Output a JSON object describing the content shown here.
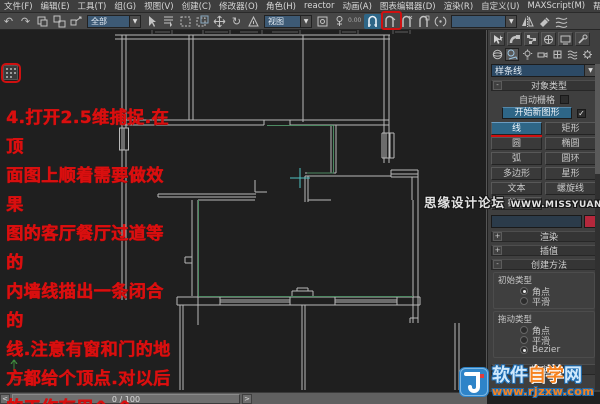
{
  "menu": {
    "items": [
      "文件(F)",
      "编辑(E)",
      "工具(T)",
      "组(G)",
      "视图(V)",
      "创建(C)",
      "修改器(O)",
      "角色(H)",
      "reactor",
      "动画(A)",
      "图表编辑器(D)",
      "渲染(R)",
      "自定义(U)",
      "MAXScript(M)",
      "帮助(H)"
    ]
  },
  "toolbar": {
    "selection_filter": "全部",
    "coord_system": "视图",
    "spinner_value": "0.00",
    "named_sets_value": "",
    "dropdown_arrow": "▼"
  },
  "icons": {
    "undo": "↶",
    "redo": "↷",
    "rotate": "↻",
    "checkmark": "✓",
    "snap_25d": "magnet-2.5d",
    "angle_snap": "magnet-angle",
    "percent_snap": "magnet-percent",
    "spinner_snap": "magnet-spinner"
  },
  "annotation": {
    "color": "#d90f0f",
    "lines": [
      "4.打开2.5维捕捉.在顶",
      "面图上顺着需要做效果",
      "图的客厅餐厅过道等的",
      "内墙线描出一条闭合的",
      "线.注意有窗和门的地",
      "方都给个顶点.对以后",
      "的工作有用^_^"
    ]
  },
  "panel": {
    "category_dropdown": "样条线",
    "object_type": {
      "title": "对象类型",
      "autogrid": "自动栅格",
      "start_new_shape": "开始新图形",
      "buttons": [
        "线",
        "矩形",
        "圆",
        "椭圆",
        "弧",
        "圆环",
        "多边形",
        "星形",
        "文本",
        "螺旋线",
        "截面"
      ],
      "active_button": "线"
    },
    "name_color": {
      "name_value": "",
      "color": "#b5283c"
    },
    "rollouts": {
      "rendering": "渲染",
      "interpolation": "插值",
      "creation_method": "创建方法",
      "keyboard_entry": "键盘输入",
      "plus": "+",
      "minus": "-"
    },
    "creation_method": {
      "initial_type_label": "初始类型",
      "drag_type_label": "拖动类型",
      "initial_options": [
        "角点",
        "平滑"
      ],
      "drag_options": [
        "角点",
        "平滑",
        "Bezier"
      ],
      "initial_selected": "角点",
      "drag_selected": "Bezier"
    }
  },
  "timeline": {
    "frame": "0 / 100",
    "prev": "<",
    "next": ">"
  },
  "watermarks": {
    "missyuan_site": "思缘设计论坛",
    "missyuan_url": "WWW.MISSYUAN.COM",
    "rjzxw_part1": "软件",
    "rjzxw_part2": "自学",
    "rjzxw_part3": "网",
    "rjzxw_url": "www.rjzxw.com"
  },
  "colors": {
    "annotation_red": "#cf1010",
    "snap_active_blue": "#2e6687",
    "spline_green": "#4d8a62",
    "cursor_teal": "#4fc1c1",
    "wall_gray": "#b9b9b9",
    "viewport_bg": "#1f1f1f",
    "panel_bg": "#3f3f3f"
  }
}
